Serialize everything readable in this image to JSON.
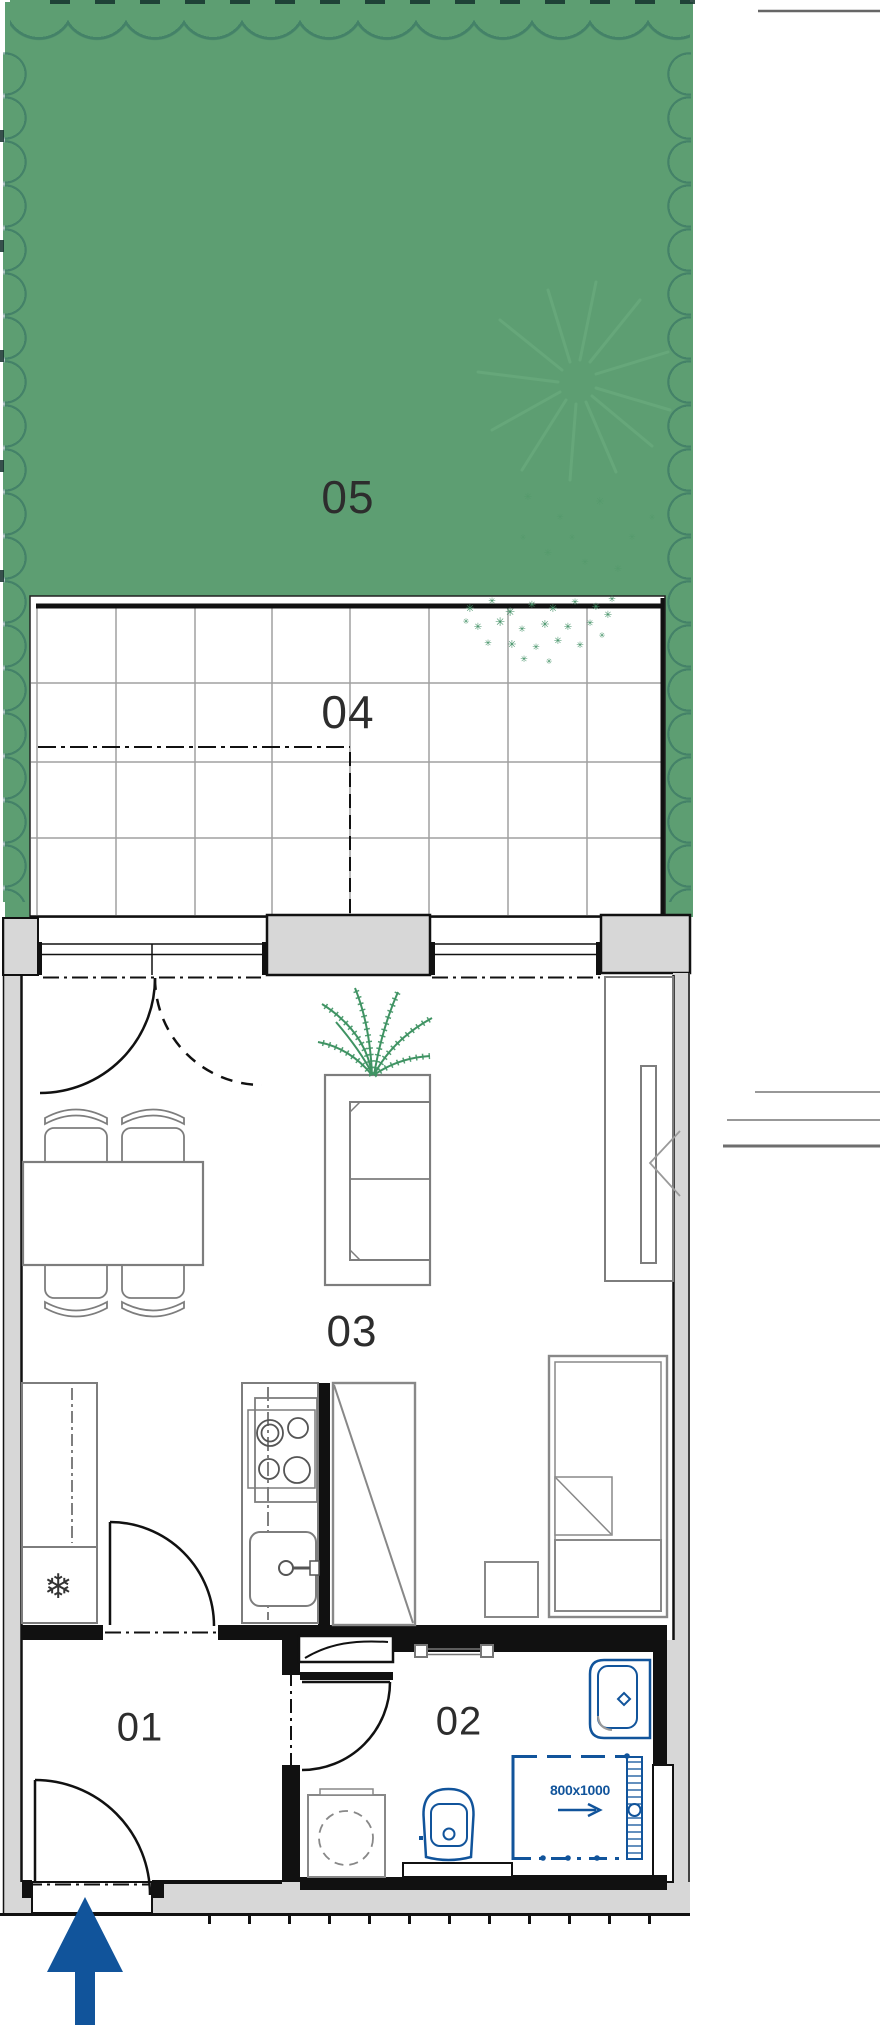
{
  "plan": {
    "title": "apartment-floor-plan",
    "rooms": [
      {
        "id": "05",
        "label": "05",
        "type": "garden"
      },
      {
        "id": "04",
        "label": "04",
        "type": "terrace"
      },
      {
        "id": "03",
        "label": "03",
        "type": "living-room-kitchen"
      },
      {
        "id": "02",
        "label": "02",
        "type": "bathroom"
      },
      {
        "id": "01",
        "label": "01",
        "type": "entrance-hall"
      }
    ],
    "shower": {
      "size_label": "800x1000"
    },
    "colors": {
      "garden_green": "#5d9e72",
      "scallop_stroke": "#3c7b68",
      "fixture_blue": "#11549b",
      "wall_gray": "#d7d7d7",
      "line_black": "#111111",
      "furniture_gray": "#7d7d7d"
    },
    "icons": [
      "entrance-arrow-icon",
      "snowflake-icon",
      "fern-plant-icon",
      "shrub-cluster-icon",
      "sunburst-plant-icon",
      "towel-rail-icon"
    ]
  }
}
